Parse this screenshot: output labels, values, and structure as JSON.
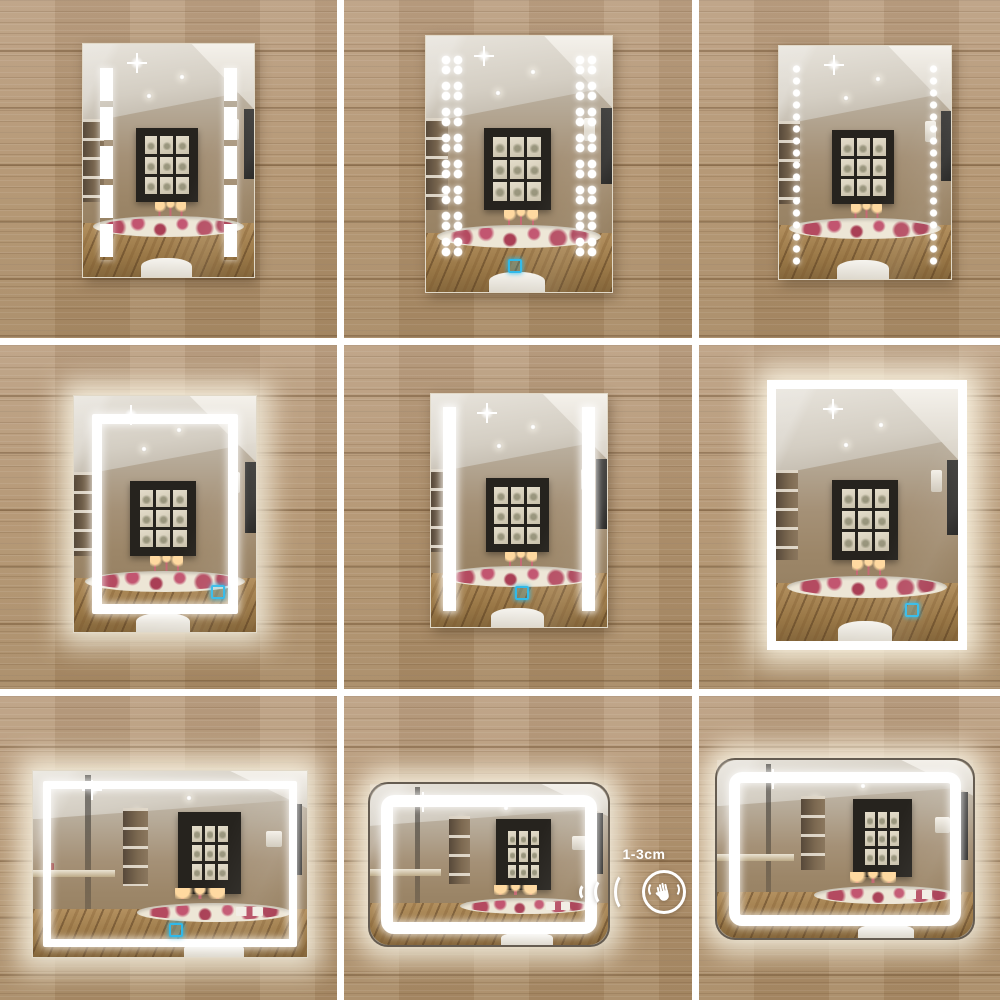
{
  "collage": {
    "grid": {
      "rows": 3,
      "cols": 3,
      "gutter_color": "#ffffff",
      "wood_color": "#b59873"
    },
    "cells": [
      {
        "position": "top-left",
        "orientation": "portrait",
        "led_pattern": "two segmented vertical LED strips",
        "backlit": false,
        "touch_sensor": false,
        "shape": "rectangular"
      },
      {
        "position": "top-center",
        "orientation": "portrait",
        "led_pattern": "paired LED dot cluster columns",
        "backlit": false,
        "touch_sensor": true,
        "shape": "rectangular"
      },
      {
        "position": "top-right",
        "orientation": "portrait",
        "led_pattern": "single LED dot columns",
        "backlit": false,
        "touch_sensor": false,
        "shape": "rectangular"
      },
      {
        "position": "middle-left",
        "orientation": "portrait",
        "led_pattern": "inset LED frame",
        "backlit": true,
        "touch_sensor": true,
        "shape": "rectangular"
      },
      {
        "position": "middle-center",
        "orientation": "portrait",
        "led_pattern": "two solid vertical LED strips",
        "backlit": false,
        "touch_sensor": true,
        "shape": "rectangular"
      },
      {
        "position": "middle-right",
        "orientation": "portrait",
        "led_pattern": "edge-lit LED frame",
        "backlit": true,
        "touch_sensor": true,
        "shape": "rectangular"
      },
      {
        "position": "bottom-left",
        "orientation": "landscape",
        "led_pattern": "inset LED frame",
        "backlit": true,
        "touch_sensor": true,
        "shape": "rectangular"
      },
      {
        "position": "bottom-center",
        "orientation": "landscape",
        "led_pattern": "rounded inset LED frame",
        "backlit": true,
        "touch_sensor": false,
        "shape": "rounded"
      },
      {
        "position": "bottom-right",
        "orientation": "landscape",
        "led_pattern": "rounded inset LED frame",
        "backlit": true,
        "touch_sensor": false,
        "shape": "rounded"
      }
    ]
  },
  "sensor_annotation": {
    "label": "1-3cm",
    "icon": "hand-wave-sensor-icon",
    "color": "#ffffff"
  },
  "colors": {
    "led_white": "#ffffff",
    "touch_sensor_blue": "#2fb9e9",
    "glow": "#fff9e9"
  }
}
